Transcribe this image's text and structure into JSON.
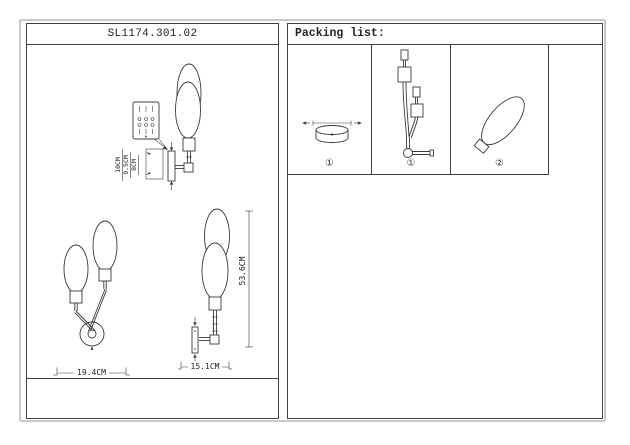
{
  "window": {
    "title": "SL1174.301.02"
  },
  "packing": {
    "header": "Packing list:",
    "items": [
      {
        "icon": "canopy-icon",
        "label": "①"
      },
      {
        "icon": "fixture-body-icon",
        "label": "①"
      },
      {
        "icon": "glass-shade-icon",
        "label": "②"
      }
    ]
  },
  "dimensions": {
    "bracket_depth": "10CM",
    "bracket_height": "9.5CM",
    "bracket_inner": "8CM",
    "front_width": "19.4CM",
    "side_width": "15.1CM",
    "total_height": "53.6CM"
  },
  "colors": {
    "line": "#3a3a3a",
    "frame": "#c9c9c9"
  }
}
